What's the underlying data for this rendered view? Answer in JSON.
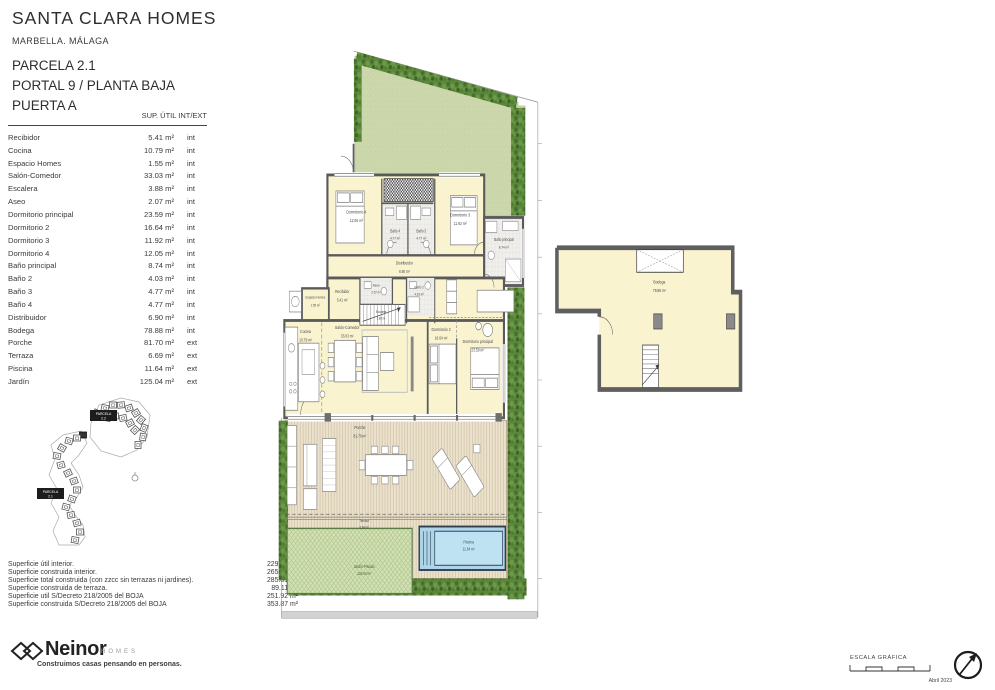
{
  "header": {
    "title": "SANTA CLARA HOMES",
    "location": "MARBELLA. MÁLAGA",
    "parcela": "PARCELA 2.1",
    "portal": "PORTAL 9 / PLANTA BAJA",
    "puerta": "PUERTA A"
  },
  "areas_table": {
    "header": "SUP. ÚTIL INT/EXT",
    "rows": [
      {
        "name": "Recibidor",
        "area": "5.41 m²",
        "type": "int"
      },
      {
        "name": "Cocina",
        "area": "10.79 m²",
        "type": "int"
      },
      {
        "name": "Espacio Homes",
        "area": "1.55 m²",
        "type": "int"
      },
      {
        "name": "Salón-Comedor",
        "area": "33.03 m²",
        "type": "int"
      },
      {
        "name": "Escalera",
        "area": "3.88 m²",
        "type": "int"
      },
      {
        "name": "Aseo",
        "area": "2.07 m²",
        "type": "int"
      },
      {
        "name": "Dormitorio principal",
        "area": "23.59 m²",
        "type": "int"
      },
      {
        "name": "Dormitorio 2",
        "area": "16.64 m²",
        "type": "int"
      },
      {
        "name": "Dormitorio 3",
        "area": "11.92 m²",
        "type": "int"
      },
      {
        "name": "Dormitorio 4",
        "area": "12.05 m²",
        "type": "int"
      },
      {
        "name": "Baño principal",
        "area": "8.74 m²",
        "type": "int"
      },
      {
        "name": "Baño 2",
        "area": "4.03 m²",
        "type": "int"
      },
      {
        "name": "Baño 3",
        "area": "4.77 m²",
        "type": "int"
      },
      {
        "name": "Baño 4",
        "area": "4.77 m²",
        "type": "int"
      },
      {
        "name": "Distribuidor",
        "area": "6.90 m²",
        "type": "int"
      },
      {
        "name": "Bodega",
        "area": "78.88 m²",
        "type": "int"
      },
      {
        "name": "Porche",
        "area": "81.70 m²",
        "type": "ext"
      },
      {
        "name": "Terraza",
        "area": "6.69 m²",
        "type": "ext"
      },
      {
        "name": "Piscina",
        "area": "11.64 m²",
        "type": "ext"
      },
      {
        "name": "Jardín",
        "area": "125.04 m²",
        "type": "ext"
      }
    ]
  },
  "summary": {
    "rows": [
      {
        "label": "Superficie útil interior.",
        "value": "229.02 m²"
      },
      {
        "label": "Superficie construida interior.",
        "value": "265.62 m²"
      },
      {
        "label": "Superficie total construida (con zzcc sin terrazas ni jardines).",
        "value": "285.81 m²"
      },
      {
        "label": "Superficie construida de terraza.",
        "value": "89.11 m²"
      },
      {
        "label": "Superficie util S/Decreto 218/2005 del BOJA",
        "value": "251.92 m²"
      },
      {
        "label": "Superficie construida S/Decreto 218/2005 del BOJA",
        "value": "353.87 m²"
      }
    ]
  },
  "site_key": {
    "parcela_top": {
      "line1": "PARCELA",
      "line2": "2.2"
    },
    "parcela_left": {
      "line1": "PARCELA",
      "line2": "2.1"
    }
  },
  "plan": {
    "labels": {
      "dorm4": {
        "name": "Dormitorio 4",
        "area": "12.05 m²"
      },
      "bano4": {
        "name": "Baño 4",
        "area": "4.77 m²"
      },
      "bano3": {
        "name": "Baño 3",
        "area": "4.77 m²"
      },
      "dorm3": {
        "name": "Dormitorio 3",
        "area": "11.92 m²"
      },
      "banop": {
        "name": "Baño principal",
        "area": "8.74 m²"
      },
      "distribuidor": {
        "name": "Distribuidor",
        "area": "6.90 m²"
      },
      "recibidor": {
        "name": "Recibidor",
        "area": "5.41 m²"
      },
      "aseo": {
        "name": "Aseo",
        "area": "2.07 m²"
      },
      "escalera": {
        "name": "Escalera",
        "area": "3.88 m²"
      },
      "bano2": {
        "name": "Baño 2",
        "area": "4.03 m²"
      },
      "espacio": {
        "name": "Espacio Homes",
        "area": "1.55 m²"
      },
      "cocina": {
        "name": "Cocina",
        "area": "10.79 m²"
      },
      "salon": {
        "name": "Salón-Comedor",
        "area": "33.03 m²"
      },
      "dorm2": {
        "name": "Dormitorio 2",
        "area": "16.64 m²"
      },
      "dormp": {
        "name": "Dormitorio principal",
        "area": "23.59 m²"
      },
      "porche": {
        "name": "Porche",
        "area": "81.70 m²"
      },
      "terraza": {
        "name": "Terraza",
        "area": "6.69 m²"
      },
      "piscina": {
        "name": "Piscina",
        "area": "11.64 m²"
      },
      "jardin": {
        "name": "Jardín Privado",
        "area": "125.04 m²"
      },
      "bodega": {
        "name": "Bodega",
        "area": "78.88 m²"
      }
    }
  },
  "footer": {
    "scale_label": "ESCALA GRÁFICA",
    "date": "Abril 2023"
  },
  "brand": {
    "name": "Neinor",
    "sub": "HOMES",
    "tagline": "Construimos casas pensando en personas."
  },
  "colors": {
    "room_fill": "#f9f3d0",
    "wall": "#5a5a5a",
    "garden": "#ccd8ac",
    "hedge": "#5c883c",
    "pool_water": "#bfe2f2",
    "deck": "#ebe2cd"
  }
}
